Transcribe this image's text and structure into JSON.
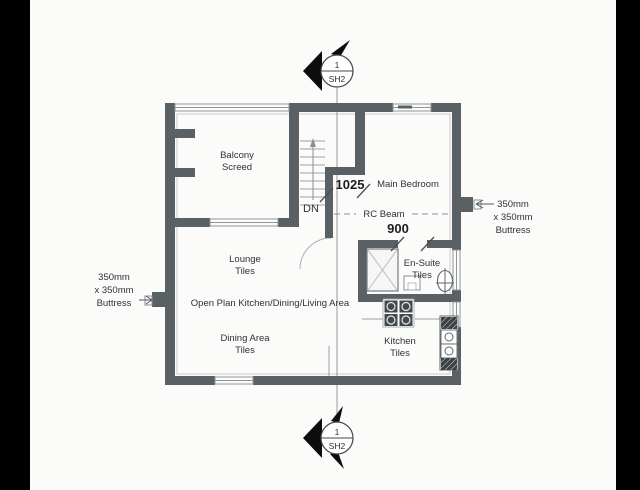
{
  "drawing": {
    "section_markers": {
      "top": {
        "detail": "1",
        "sheet": "SH2"
      },
      "bottom": {
        "detail": "1",
        "sheet": "SH2"
      }
    },
    "rooms": {
      "balcony": {
        "name": "Balcony",
        "finish": "Screed"
      },
      "main_bedroom": {
        "name": "Main Bedroom"
      },
      "lounge": {
        "name": "Lounge",
        "finish": "Tiles"
      },
      "en_suite": {
        "name": "En-Suite",
        "finish": "Tiles"
      },
      "open_plan": {
        "name": "Open Plan Kitchen/Dining/Living Area"
      },
      "dining_area": {
        "name": "Dining Area",
        "finish": "Tiles"
      },
      "kitchen": {
        "name": "Kitchen",
        "finish": "Tiles"
      }
    },
    "dimensions": {
      "stair_opening": "1025",
      "ensuite_opening": "900"
    },
    "annotations": {
      "stair_direction": "DN",
      "beam": "RC Beam",
      "buttress_left": {
        "line1": "350mm",
        "line2": "x 350mm",
        "line3": "Buttress"
      },
      "buttress_right": {
        "line1": "350mm",
        "line2": "x 350mm",
        "line3": "Buttress"
      }
    },
    "colors": {
      "wall": "#5a6164",
      "paper": "#fbfbf9",
      "matte": "#000000",
      "thin_line": "#9aa0a2"
    }
  }
}
